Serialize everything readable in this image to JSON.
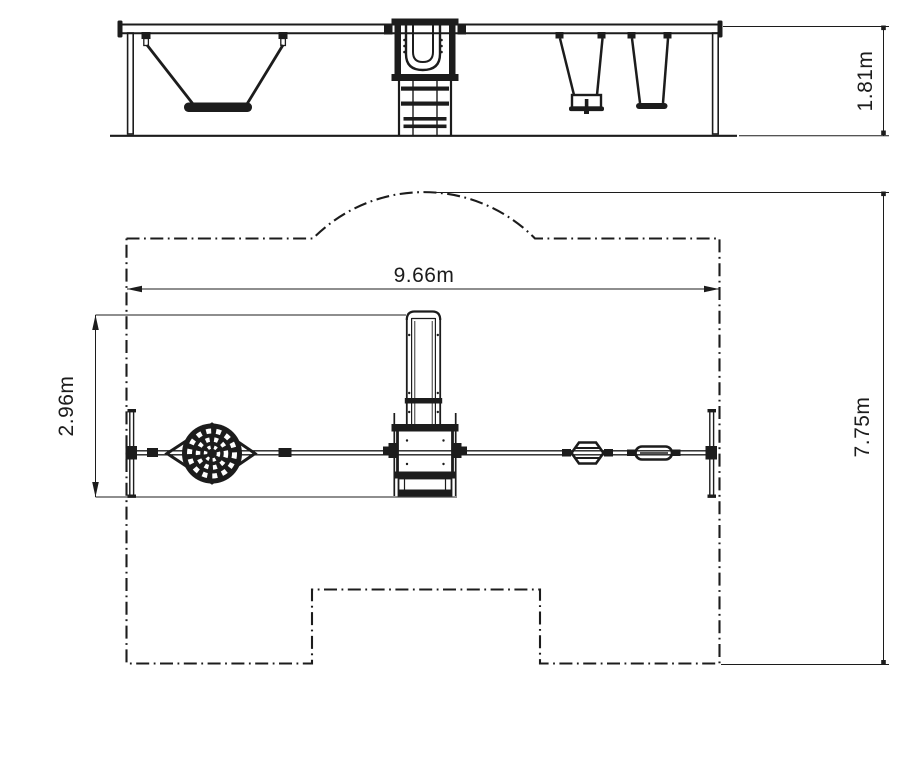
{
  "drawing": {
    "background_color": "#ffffff",
    "line_color": "#1c1c1c",
    "views": {
      "front_elevation": {
        "dimensions": {
          "frame_height": "1.81m"
        }
      },
      "plan": {
        "dimensions": {
          "frame_width": "9.66m",
          "unit_depth": "2.96m",
          "safety_area_depth": "7.75m"
        }
      }
    }
  }
}
